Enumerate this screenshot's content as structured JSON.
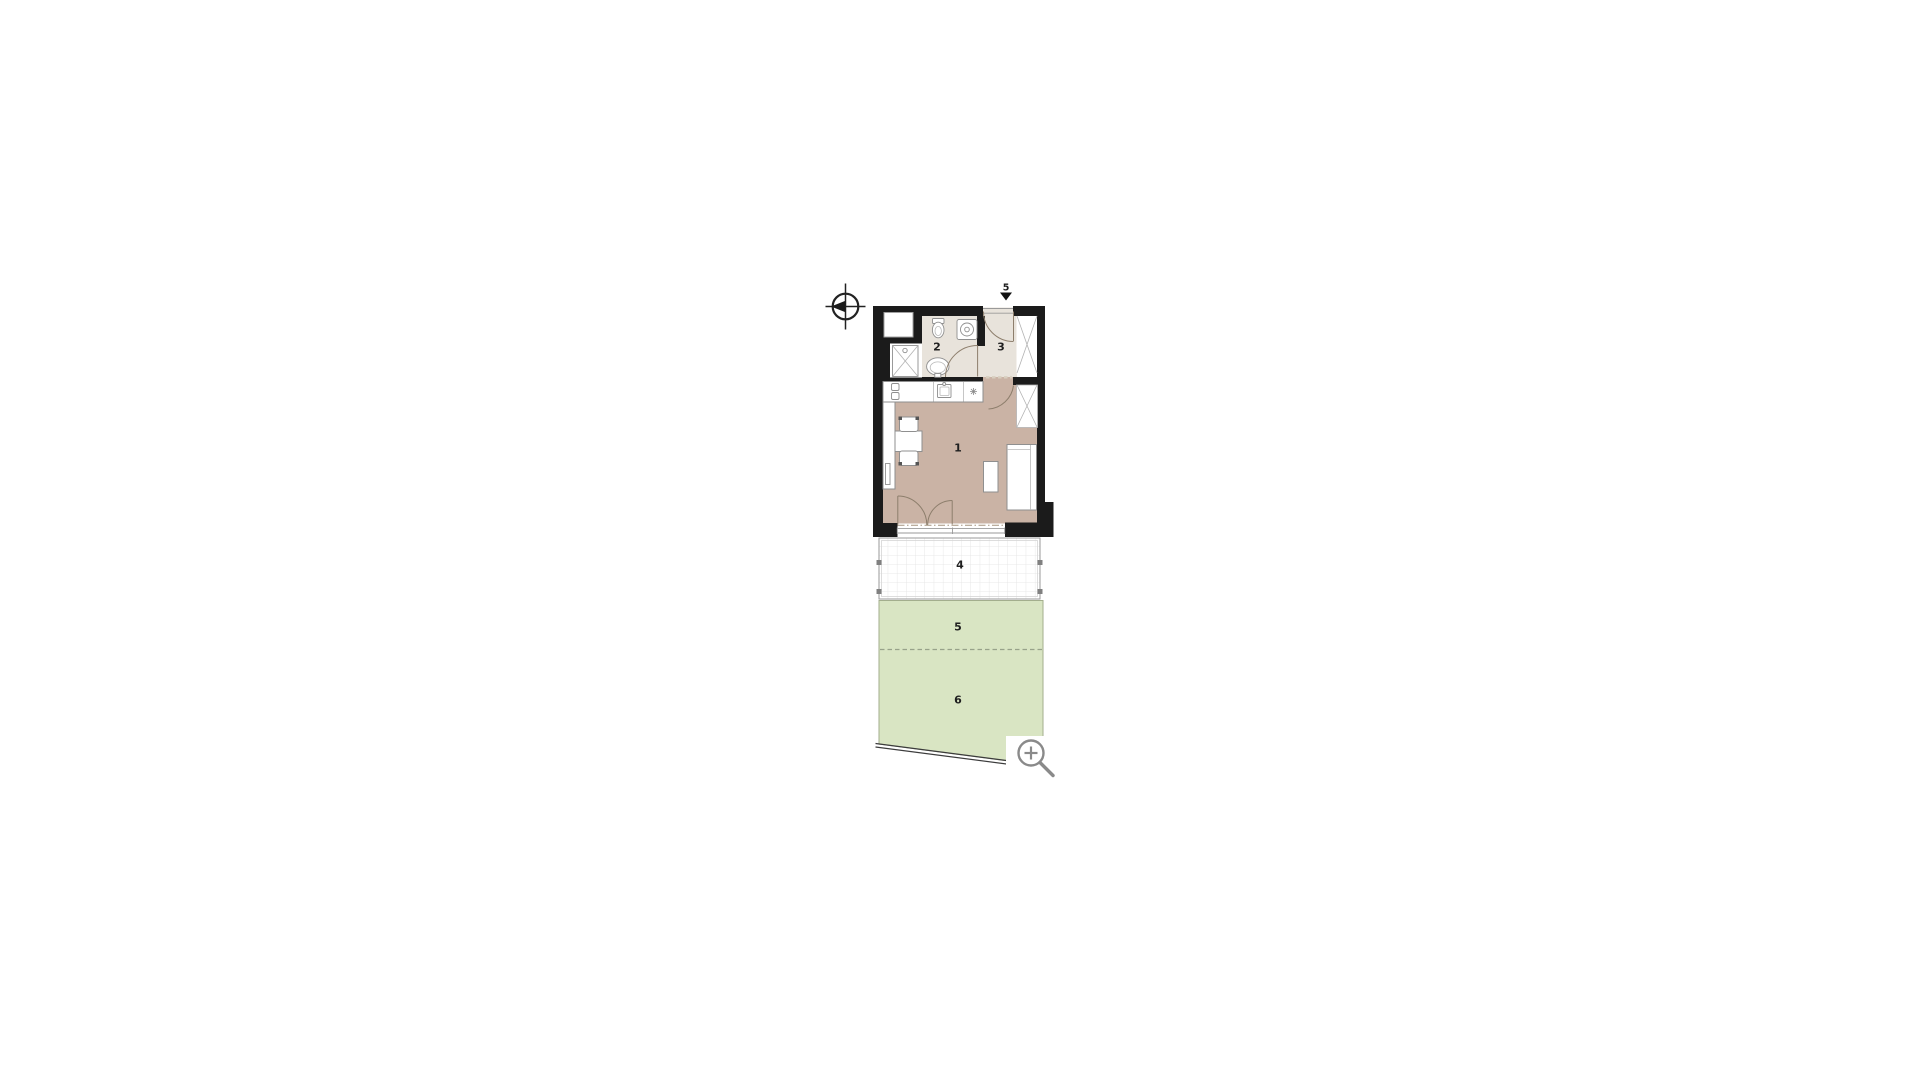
{
  "canvas": {
    "background": "#ffffff"
  },
  "floor_plan": {
    "section_marker": {
      "label": "5"
    },
    "rooms": [
      {
        "name": "main-room",
        "number": "1"
      },
      {
        "name": "bathroom",
        "number": "2"
      },
      {
        "name": "entry-hall",
        "number": "3"
      },
      {
        "name": "terrace",
        "number": "4"
      },
      {
        "name": "garden-front",
        "number": "5"
      },
      {
        "name": "garden-back",
        "number": "6"
      }
    ],
    "colors": {
      "wall": "#1b1b1b",
      "floor_main": "#cab3a5",
      "floor_wet": "#e8e3db",
      "garden": "#d9e5c3",
      "garden_edge": "#a3ae8d",
      "garden_dash": "#98a28a",
      "terrace_line": "#9a9a9a",
      "fixture": "#8f8f8f",
      "door": "#8d7e6c",
      "dash_line": "#a5937f",
      "icon": "#8a8a8a",
      "ink": "#1f1f1f"
    }
  },
  "controls": {
    "zoom_button": {
      "icon": "magnifier"
    }
  }
}
